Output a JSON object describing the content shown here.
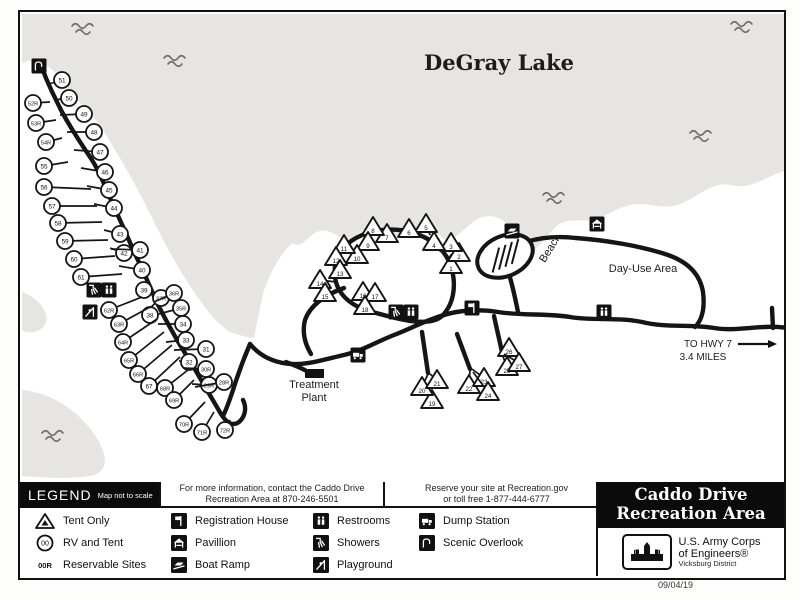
{
  "title_box": {
    "line1": "Caddo Drive",
    "line2": "Recreation Area"
  },
  "agency": {
    "line1": "U.S. Army Corps",
    "line2": "of Engineers®",
    "sub": "Vicksburg District"
  },
  "date_stamp": "09/04/19",
  "info_boxes": {
    "contact_line1": "For more information, contact the Caddo Drive",
    "contact_line2": "Recreation Area at 870-246-5501",
    "reserve_line1": "Reserve your site at Recreation.gov",
    "reserve_line2": "or toll free 1-877-444-6777"
  },
  "legend": {
    "title": "LEGEND",
    "scale_note": "Map not to scale",
    "site_types": [
      {
        "icon": "tent-legend",
        "label": "Tent Only"
      },
      {
        "icon": "rv-legend",
        "label": "RV and Tent"
      },
      {
        "icon": "reservable-legend",
        "label": "Reservable Sites"
      }
    ],
    "facilities": [
      {
        "icon": "registration-house",
        "label": "Registration House",
        "col": 1,
        "row": 0
      },
      {
        "icon": "pavillion",
        "label": "Pavillion",
        "col": 1,
        "row": 1
      },
      {
        "icon": "boat-ramp",
        "label": "Boat Ramp",
        "col": 1,
        "row": 2
      },
      {
        "icon": "restrooms",
        "label": "Restrooms",
        "col": 2,
        "row": 0
      },
      {
        "icon": "showers",
        "label": "Showers",
        "col": 2,
        "row": 1
      },
      {
        "icon": "playground",
        "label": "Playground",
        "col": 2,
        "row": 2
      },
      {
        "icon": "dump-station",
        "label": "Dump Station",
        "col": 3,
        "row": 0
      },
      {
        "icon": "scenic-overlook",
        "label": "Scenic Overlook",
        "col": 3,
        "row": 1
      }
    ]
  },
  "colors": {
    "lake": "#e6e5e2",
    "road": "#151515",
    "wave": "#6f6f6d",
    "text": "#111111"
  },
  "map": {
    "lake_name": "DeGray Lake",
    "labels": [
      {
        "text": "DeGray Lake",
        "x": 497,
        "y": 68,
        "size": 21,
        "serif": true,
        "bold": true,
        "rot": 0
      },
      {
        "text": "Beach",
        "x": 551,
        "y": 248,
        "size": 11,
        "serif": false,
        "bold": false,
        "rot": -58
      },
      {
        "text": "Day-Use Area",
        "x": 641,
        "y": 270,
        "size": 11,
        "serif": false,
        "bold": false,
        "rot": 0
      },
      {
        "text": "Treatment",
        "x": 312,
        "y": 386,
        "size": 11,
        "serif": false,
        "bold": false,
        "rot": 0
      },
      {
        "text": "Plant",
        "x": 312,
        "y": 399,
        "size": 11,
        "serif": false,
        "bold": false,
        "rot": 0
      },
      {
        "text": "TO HWY 7",
        "x": 706,
        "y": 345,
        "size": 10,
        "serif": false,
        "bold": false,
        "rot": 0
      },
      {
        "text": "3.4 MILES",
        "x": 701,
        "y": 358,
        "size": 10,
        "serif": false,
        "bold": false,
        "rot": 0
      }
    ],
    "waves": [
      [
        70,
        24
      ],
      [
        162,
        56
      ],
      [
        729,
        22
      ],
      [
        688,
        131
      ],
      [
        541,
        193
      ],
      [
        40,
        431
      ]
    ],
    "icons": [
      {
        "name": "scenic-overlook",
        "x": 37,
        "y": 64
      },
      {
        "name": "showers",
        "x": 92,
        "y": 288
      },
      {
        "name": "restrooms",
        "x": 107,
        "y": 288
      },
      {
        "name": "playground",
        "x": 88,
        "y": 310
      },
      {
        "name": "showers",
        "x": 394,
        "y": 310
      },
      {
        "name": "restrooms",
        "x": 409,
        "y": 310
      },
      {
        "name": "dump-station",
        "x": 356,
        "y": 353
      },
      {
        "name": "registration-house",
        "x": 470,
        "y": 306
      },
      {
        "name": "boat-ramp",
        "x": 510,
        "y": 229
      },
      {
        "name": "pavillion",
        "x": 595,
        "y": 222
      },
      {
        "name": "restrooms",
        "x": 602,
        "y": 310
      }
    ],
    "sites": [
      {
        "n": "51",
        "t": "rv",
        "x": 60,
        "y": 78,
        "ax": 47,
        "ay": 82
      },
      {
        "n": "50",
        "t": "rv",
        "x": 67,
        "y": 96,
        "ax": 52,
        "ay": 98
      },
      {
        "n": "49",
        "t": "rv",
        "x": 82,
        "y": 112,
        "ax": 58,
        "ay": 113
      },
      {
        "n": "48",
        "t": "rv",
        "x": 92,
        "y": 130,
        "ax": 65,
        "ay": 130
      },
      {
        "n": "47",
        "t": "rv",
        "x": 98,
        "y": 150,
        "ax": 72,
        "ay": 148
      },
      {
        "n": "46",
        "t": "rv",
        "x": 103,
        "y": 170,
        "ax": 79,
        "ay": 166
      },
      {
        "n": "45",
        "t": "rv",
        "x": 107,
        "y": 188,
        "ax": 85,
        "ay": 184
      },
      {
        "n": "44",
        "t": "rv",
        "x": 112,
        "y": 206,
        "ax": 92,
        "ay": 202
      },
      {
        "n": "43",
        "t": "rv",
        "x": 118,
        "y": 232,
        "ax": 102,
        "ay": 228
      },
      {
        "n": "42",
        "t": "rv",
        "x": 122,
        "y": 251,
        "ax": 108,
        "ay": 246
      },
      {
        "n": "41",
        "t": "rv",
        "x": 138,
        "y": 248,
        "ax": 109,
        "ay": 247
      },
      {
        "n": "40",
        "t": "rv",
        "x": 140,
        "y": 268,
        "ax": 117,
        "ay": 264
      },
      {
        "n": "39",
        "t": "rv",
        "x": 142,
        "y": 288,
        "ax": 137,
        "ay": 290
      },
      {
        "n": "38",
        "t": "rv",
        "x": 148,
        "y": 313,
        "ax": 150,
        "ay": 314
      },
      {
        "n": "37R",
        "t": "rv",
        "x": 159,
        "y": 296,
        "ax": 148,
        "ay": 306
      },
      {
        "n": "36R",
        "t": "rv",
        "x": 172,
        "y": 291,
        "ax": 152,
        "ay": 300
      },
      {
        "n": "35R",
        "t": "rv",
        "x": 179,
        "y": 306,
        "ax": 157,
        "ay": 312
      },
      {
        "n": "34",
        "t": "rv",
        "x": 181,
        "y": 322,
        "ax": 156,
        "ay": 322
      },
      {
        "n": "33",
        "t": "rv",
        "x": 184,
        "y": 338,
        "ax": 164,
        "ay": 340
      },
      {
        "n": "32",
        "t": "rv",
        "x": 187,
        "y": 360,
        "ax": 177,
        "ay": 359
      },
      {
        "n": "31",
        "t": "rv",
        "x": 204,
        "y": 347,
        "ax": 172,
        "ay": 348
      },
      {
        "n": "30R",
        "t": "rv",
        "x": 204,
        "y": 367,
        "ax": 181,
        "ay": 366
      },
      {
        "n": "29R",
        "t": "rv",
        "x": 207,
        "y": 383,
        "ax": 190,
        "ay": 382
      },
      {
        "n": "28R",
        "t": "rv",
        "x": 222,
        "y": 380,
        "ax": 193,
        "ay": 385
      },
      {
        "n": "52R",
        "t": "rv",
        "x": 31,
        "y": 101,
        "ax": 48,
        "ay": 100
      },
      {
        "n": "53R",
        "t": "rv",
        "x": 34,
        "y": 121,
        "ax": 54,
        "ay": 118
      },
      {
        "n": "54R",
        "t": "rv",
        "x": 44,
        "y": 140,
        "ax": 60,
        "ay": 136
      },
      {
        "n": "55",
        "t": "rv",
        "x": 42,
        "y": 164,
        "ax": 66,
        "ay": 160
      },
      {
        "n": "56",
        "t": "rv",
        "x": 42,
        "y": 185,
        "ax": 89,
        "ay": 187
      },
      {
        "n": "57",
        "t": "rv",
        "x": 50,
        "y": 204,
        "ax": 95,
        "ay": 204
      },
      {
        "n": "58",
        "t": "rv",
        "x": 56,
        "y": 221,
        "ax": 100,
        "ay": 220
      },
      {
        "n": "59",
        "t": "rv",
        "x": 63,
        "y": 239,
        "ax": 106,
        "ay": 238
      },
      {
        "n": "60",
        "t": "rv",
        "x": 72,
        "y": 257,
        "ax": 113,
        "ay": 254
      },
      {
        "n": "61",
        "t": "rv",
        "x": 79,
        "y": 275,
        "ax": 120,
        "ay": 272
      },
      {
        "n": "62R",
        "t": "rv",
        "x": 107,
        "y": 308,
        "ax": 140,
        "ay": 295
      },
      {
        "n": "63R",
        "t": "rv",
        "x": 117,
        "y": 322,
        "ax": 148,
        "ay": 305
      },
      {
        "n": "64R",
        "t": "rv",
        "x": 121,
        "y": 340,
        "ax": 155,
        "ay": 317
      },
      {
        "n": "65R",
        "t": "rv",
        "x": 127,
        "y": 358,
        "ax": 162,
        "ay": 330
      },
      {
        "n": "66R",
        "t": "rv",
        "x": 136,
        "y": 372,
        "ax": 170,
        "ay": 343
      },
      {
        "n": "67",
        "t": "rv",
        "x": 147,
        "y": 384,
        "ax": 178,
        "ay": 355
      },
      {
        "n": "68R",
        "t": "rv",
        "x": 163,
        "y": 386,
        "ax": 186,
        "ay": 368
      },
      {
        "n": "69R",
        "t": "rv",
        "x": 172,
        "y": 398,
        "ax": 192,
        "ay": 378
      },
      {
        "n": "70R",
        "t": "rv",
        "x": 182,
        "y": 422,
        "ax": 203,
        "ay": 400
      },
      {
        "n": "71R",
        "t": "rv",
        "x": 200,
        "y": 430,
        "ax": 212,
        "ay": 410
      },
      {
        "n": "72R",
        "t": "rv",
        "x": 223,
        "y": 428,
        "ax": 228,
        "ay": 418
      },
      {
        "n": "1",
        "t": "tent",
        "x": 449,
        "y": 263,
        "ax": 448,
        "ay": 272
      },
      {
        "n": "2",
        "t": "tent",
        "x": 457,
        "y": 251,
        "ax": 452,
        "ay": 260
      },
      {
        "n": "3",
        "t": "tent",
        "x": 449,
        "y": 241,
        "ax": 446,
        "ay": 250
      },
      {
        "n": "4",
        "t": "tent",
        "x": 432,
        "y": 240,
        "ax": 435,
        "ay": 248
      },
      {
        "n": "5",
        "t": "tent",
        "x": 424,
        "y": 222,
        "ax": 428,
        "ay": 233
      },
      {
        "n": "6",
        "t": "tent",
        "x": 407,
        "y": 227,
        "ax": 412,
        "ay": 235
      },
      {
        "n": "7",
        "t": "tent",
        "x": 385,
        "y": 232,
        "ax": null,
        "ay": null
      },
      {
        "n": "8",
        "t": "tent",
        "x": 371,
        "y": 225,
        "ax": 371,
        "ay": 234
      },
      {
        "n": "9",
        "t": "tent",
        "x": 366,
        "y": 240,
        "ax": null,
        "ay": null
      },
      {
        "n": "10",
        "t": "tent",
        "x": 355,
        "y": 253,
        "ax": null,
        "ay": null
      },
      {
        "n": "11",
        "t": "tent",
        "x": 342,
        "y": 243,
        "ax": null,
        "ay": null
      },
      {
        "n": "12",
        "t": "tent",
        "x": 334,
        "y": 255,
        "ax": null,
        "ay": null
      },
      {
        "n": "13",
        "t": "tent",
        "x": 338,
        "y": 268,
        "ax": null,
        "ay": null
      },
      {
        "n": "14",
        "t": "tent",
        "x": 318,
        "y": 278,
        "ax": 334,
        "ay": 280
      },
      {
        "n": "15",
        "t": "tent",
        "x": 323,
        "y": 291,
        "ax": 336,
        "ay": 290
      },
      {
        "n": "16",
        "t": "tent",
        "x": 361,
        "y": 290,
        "ax": null,
        "ay": null
      },
      {
        "n": "17",
        "t": "tent",
        "x": 373,
        "y": 291,
        "ax": null,
        "ay": null
      },
      {
        "n": "18",
        "t": "tent",
        "x": 363,
        "y": 304,
        "ax": null,
        "ay": null
      },
      {
        "n": "19",
        "t": "tent",
        "x": 430,
        "y": 398,
        "ax": 424,
        "ay": 386
      },
      {
        "n": "20",
        "t": "tent",
        "x": 420,
        "y": 385,
        "ax": 426,
        "ay": 372
      },
      {
        "n": "21",
        "t": "tent",
        "x": 435,
        "y": 378,
        "ax": 428,
        "ay": 372
      },
      {
        "n": "22",
        "t": "tent",
        "x": 467,
        "y": 383,
        "ax": 468,
        "ay": 368
      },
      {
        "n": "23",
        "t": "tent",
        "x": 482,
        "y": 376,
        "ax": 470,
        "ay": 367
      },
      {
        "n": "24",
        "t": "tent",
        "x": 486,
        "y": 390,
        "ax": 471,
        "ay": 370
      },
      {
        "n": "25",
        "t": "tent",
        "x": 505,
        "y": 365,
        "ax": 500,
        "ay": 352
      },
      {
        "n": "26",
        "t": "tent",
        "x": 507,
        "y": 346,
        "ax": 501,
        "ay": 350
      },
      {
        "n": "27",
        "t": "tent",
        "x": 517,
        "y": 361,
        "ax": 502,
        "ay": 352
      }
    ],
    "treatment_plant_rect": {
      "x": 303,
      "y": 367,
      "w": 19,
      "h": 9
    },
    "hwy_arrow": {
      "x1": 736,
      "y1": 342,
      "x2": 766,
      "y2": 342
    }
  }
}
